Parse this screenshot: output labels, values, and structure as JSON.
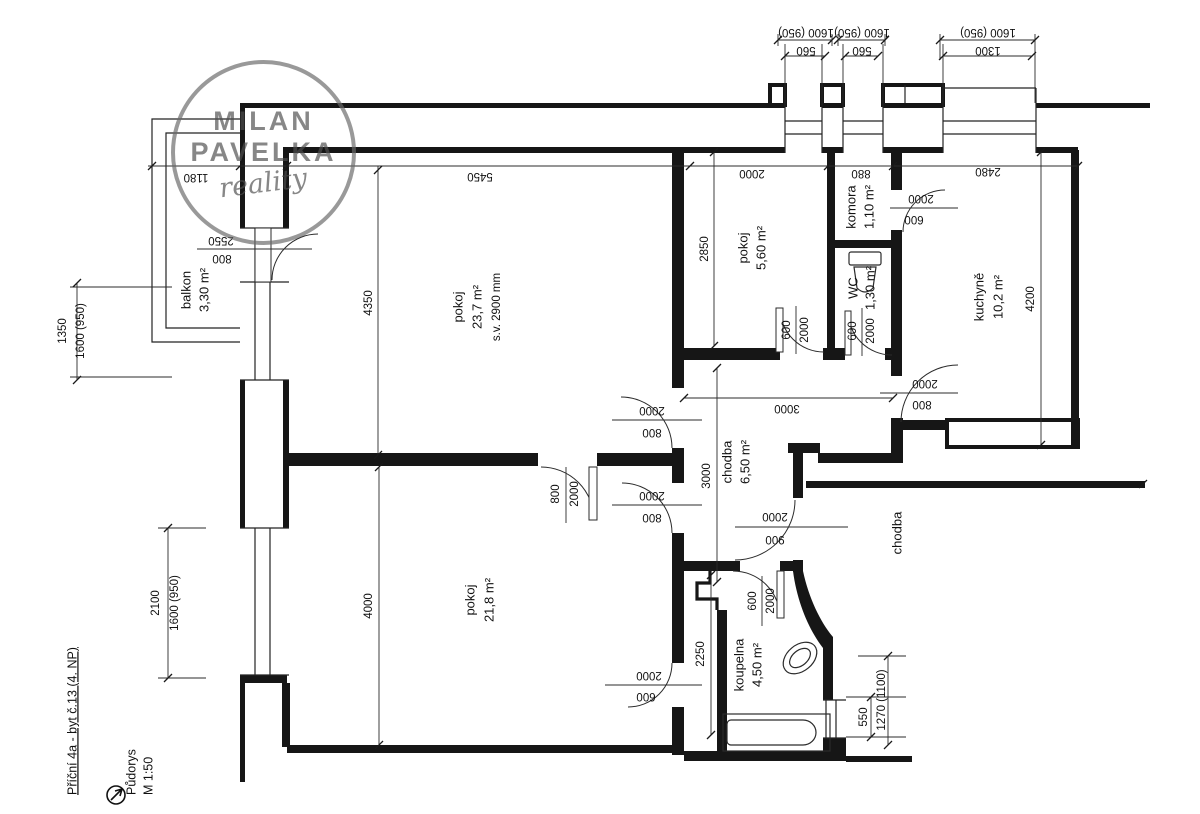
{
  "watermark": {
    "line1": "MILAN",
    "line2": "PAVELKA",
    "script": "reality"
  },
  "title_block": {
    "address": "Příční 4a - byt č.13 (4. NP)",
    "drawing_name": "Půdorys",
    "scale": "M 1:50"
  },
  "rooms": {
    "balkon": {
      "name": "balkon",
      "area": "3,30 m²"
    },
    "pokoj1": {
      "name": "pokoj",
      "area": "23,7 m²",
      "note": "s.v. 2900 mm"
    },
    "pokoj2": {
      "name": "pokoj",
      "area": "5,60 m²"
    },
    "komora": {
      "name": "komora",
      "area": "1,10 m²"
    },
    "wc": {
      "name": "WC",
      "area": "1,30 m²"
    },
    "kuchyne": {
      "name": "kuchyně",
      "area": "10,2 m²"
    },
    "chodba": {
      "name": "chodba",
      "area": "6,50 m²"
    },
    "pokoj3": {
      "name": "pokoj",
      "area": "21,8 m²"
    },
    "koupelna": {
      "name": "koupelna",
      "area": "4,50 m²"
    },
    "chodba_spolecna": {
      "name": "chodba"
    }
  },
  "dims": {
    "top": [
      {
        "size": "1600 (950)",
        "width": "560"
      },
      {
        "size": "1600 (950)",
        "width": "560"
      },
      {
        "size": "1600 (950)",
        "width": "1300"
      }
    ],
    "chain": [
      "1180",
      "5450",
      "2000",
      "880",
      "2480"
    ],
    "left": [
      {
        "a": "1350",
        "b": "1600 (950)"
      },
      {
        "a": "2100",
        "b": "1600 (950)"
      }
    ],
    "v4350": "4350",
    "v2850": "2850",
    "v3000": "3000",
    "h3000": "3000",
    "v4200": "4200",
    "v4000": "4000",
    "v2250": "2250",
    "v550": "550",
    "v1270": "1270 (1100)"
  },
  "doors": {
    "balkon": [
      "2550",
      "800"
    ],
    "pokoj1": [
      "2000",
      "800"
    ],
    "mezi": [
      "800",
      "2000"
    ],
    "pokoj3": [
      "2000",
      "800"
    ],
    "vstup": [
      "2000",
      "900"
    ],
    "pokoj2": [
      "600",
      "2000"
    ],
    "wc": [
      "600",
      "2000"
    ],
    "komora": [
      "2000",
      "600"
    ],
    "kuchyne": [
      "2000",
      "800"
    ],
    "pokoj3b": [
      "2000",
      "600"
    ],
    "koupelna": [
      "600",
      "2000"
    ]
  },
  "colors": {
    "line": "#161616",
    "text": "#111111",
    "logo": "#595959"
  }
}
